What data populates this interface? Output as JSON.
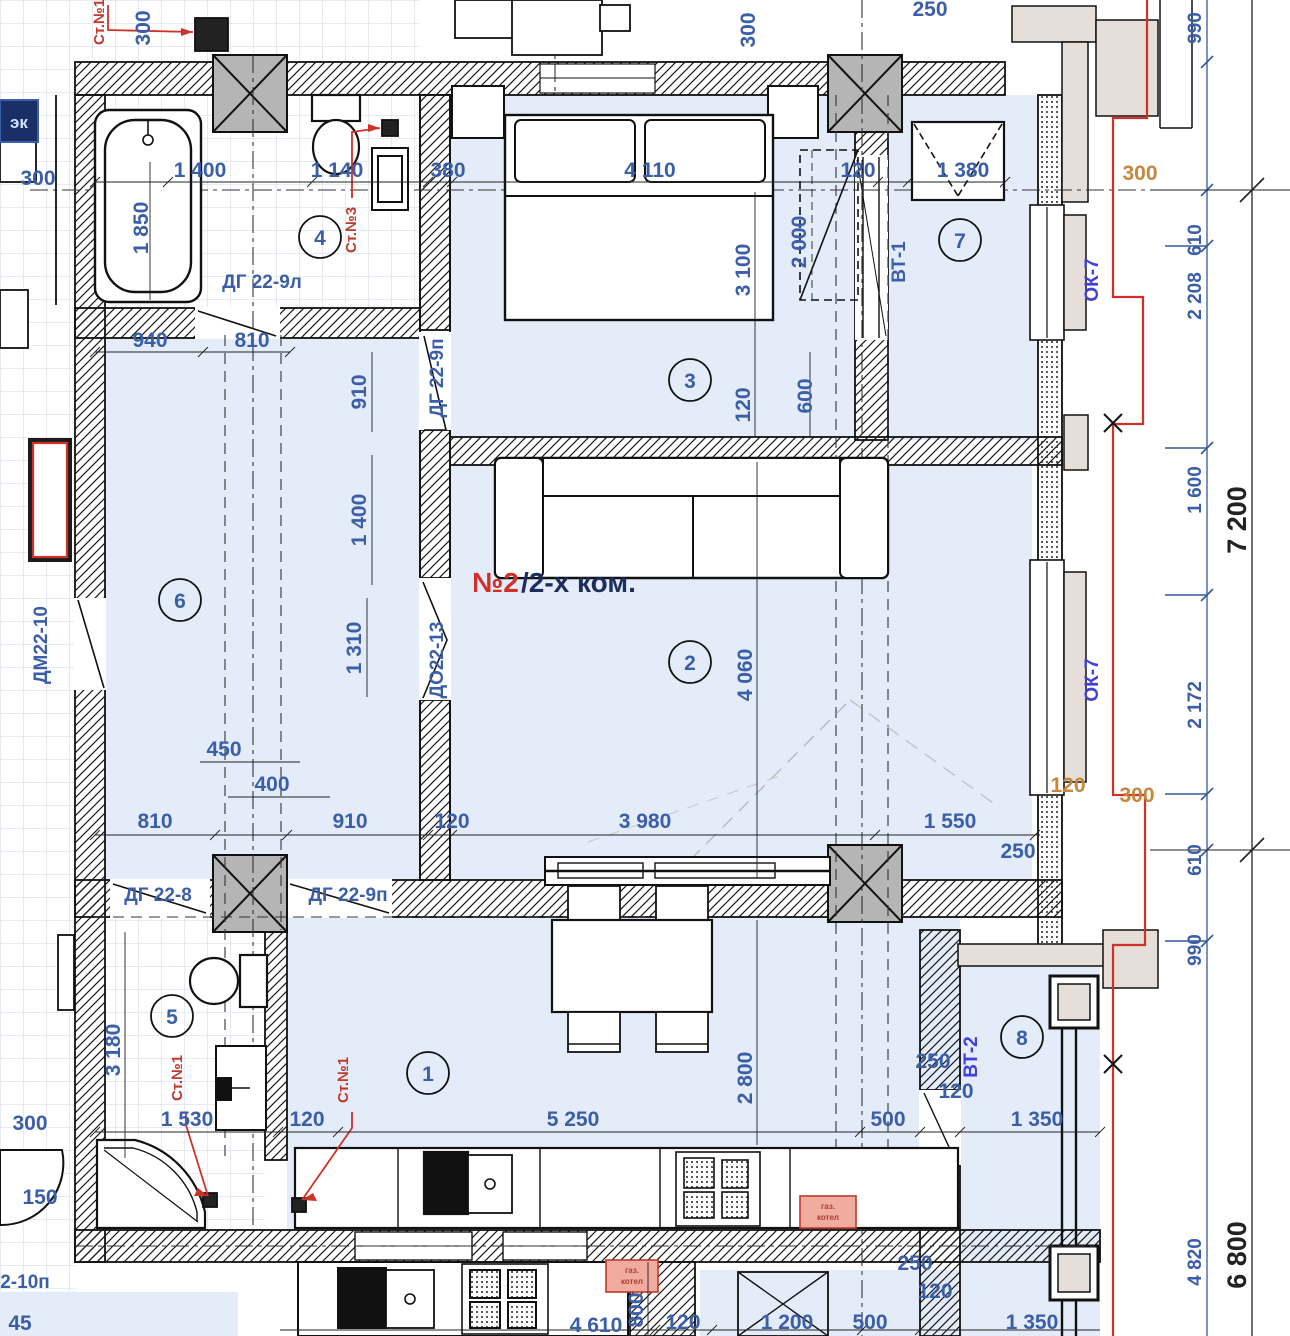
{
  "title": {
    "red": "№2",
    "dark": "/2-х ком."
  },
  "rooms": {
    "r1": "1",
    "r2": "2",
    "r3": "3",
    "r4": "4",
    "r5": "5",
    "r6": "6",
    "r7": "7",
    "r8": "8"
  },
  "labels": {
    "vt1": "ВТ-1",
    "vt2": "ВТ-2",
    "ok7_a": "ОК-7",
    "ok7_b": "ОК-7",
    "dg229l": "ДГ 22-9л",
    "dg229p_vert": "ДГ 22-9п",
    "do2213": "ДО22-13",
    "dm2210": "ДМ22-10",
    "dg228": "ДГ 22-8",
    "dg229p_horiz": "ДГ 22-9п",
    "dm2210p": "2-10п",
    "ek": "эк"
  },
  "risers": {
    "top": "Ст.№1",
    "bath": "Ст.№3",
    "wc_a": "Ст.№1",
    "wc_b": "Ст.№1"
  },
  "boiler": {
    "a1": "газ.",
    "a2": "котел",
    "b1": "газ.",
    "b2": "котел"
  },
  "dims": {
    "top_300_left": "300",
    "top_v300_left": "300",
    "bath_1850": "1 850",
    "w1400": "1 400",
    "w1140": "1 140",
    "bed_380": "380",
    "bed_4110": "4 110",
    "bed_120": "120",
    "vent_1380": "1 380",
    "top_v300_mid": "300",
    "top_250": "250",
    "bed_3100": "3 100",
    "ward_2000": "2 000",
    "cor_940": "940",
    "cor_810": "810",
    "cor_910": "910",
    "cor_1400": "1 400",
    "cor_1310": "1 310",
    "door_120": "120",
    "door_600": "600",
    "liv_4060": "4 060",
    "cor_450": "450",
    "cor_400": "400",
    "row_810": "810",
    "row_910": "910",
    "row_120": "120",
    "row_3980": "3 980",
    "row_1550": "1 550",
    "row_250": "250",
    "row_or120": "120",
    "right_300a": "300",
    "right_300b": "300",
    "kit_2800": "2 800",
    "kit_5250": "5 250",
    "wc_3180": "3 180",
    "wc_1530": "1 530",
    "wc_120": "120",
    "b8_250": "250",
    "b8_120": "120",
    "b8_500": "500",
    "b8_1350": "1 350",
    "bot_4610": "4 610",
    "bot_800": "800",
    "bot_120": "120",
    "bot_1200": "1 200",
    "bot_500": "500",
    "bot_1350": "1 350",
    "bot_250": "250",
    "bot_120b": "120",
    "left_300": "300",
    "left_150": "150",
    "left_45": "45",
    "chain": {
      "c990a": "990",
      "c610a": "610",
      "c2208": "2 208",
      "c1600": "1 600",
      "c2172": "2 172",
      "c610b": "610",
      "c990b": "990",
      "c4820": "4 820",
      "c7200": "7 200",
      "c6800": "6 800"
    }
  },
  "colors": {
    "dim_blue": "#3b5ea8",
    "accent_red": "#cf3128",
    "orange": "#c4873b",
    "room_fill": "#e3ecf8"
  }
}
